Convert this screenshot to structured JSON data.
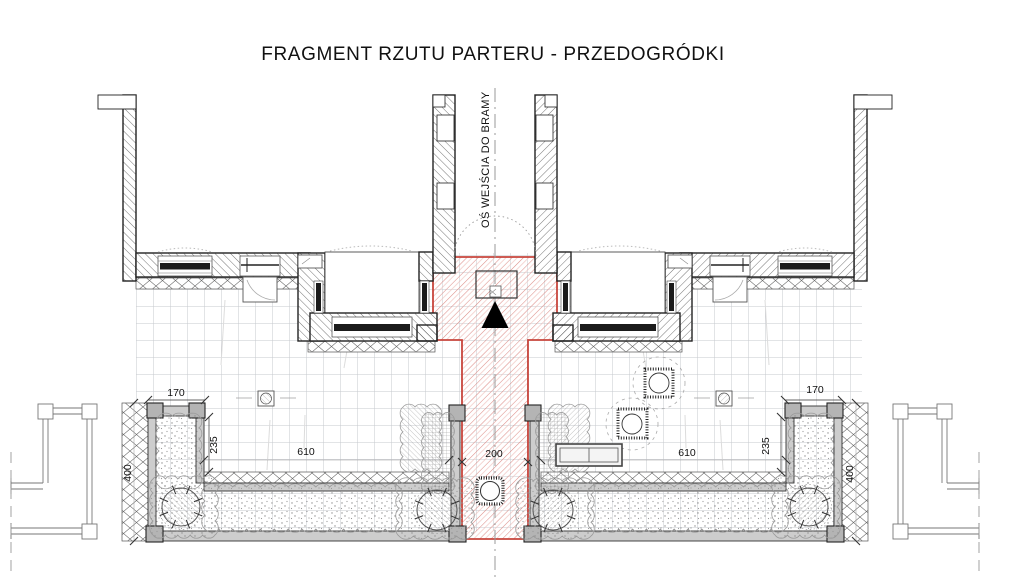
{
  "title": "FRAGMENT RZUTU PARTERU - PRZEDOGRÓDKI",
  "axis_label": "OŚ WEJŚCIA DO BRAMY",
  "dimensions": {
    "path_width": "200",
    "left": {
      "front_width": "170",
      "side_depth": "235",
      "bed_length": "610",
      "garden_depth": "400"
    },
    "right": {
      "front_width": "170",
      "side_depth": "235",
      "bed_length": "610",
      "garden_depth": "400"
    }
  },
  "markers": {
    "entrance_triangle": "entrance-direction-marker",
    "doormat": "entrance-doormat",
    "gate_swing": "gate-door-swing-arc",
    "centerline": "entrance-axis-centerline"
  },
  "colors": {
    "path_outline": "#c8453c",
    "path_hatch": "#dd8e88",
    "wall_hatch": "#3a3a3a",
    "planter_wall_fill": "#cdcdcd",
    "planter_post_fill": "#b4b4b4",
    "paving_grid": "#c6c8ce",
    "centerline": "#999999",
    "vegetation": "#8f8f8f"
  }
}
